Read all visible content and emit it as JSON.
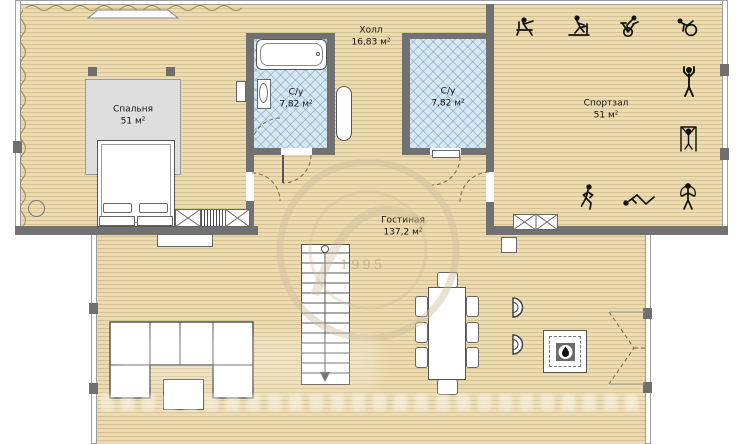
{
  "plan": {
    "title": "floor-plan",
    "rooms": {
      "bedroom": {
        "name": "Спальня",
        "area": "51 м²"
      },
      "hall": {
        "name": "Холл",
        "area": "16,83 м²"
      },
      "bathroom1": {
        "name": "С/у",
        "area": "7,82 м²"
      },
      "bathroom2": {
        "name": "С/у",
        "area": "7,82 м²"
      },
      "gym": {
        "name": "Спортзал",
        "area": "51 м²"
      },
      "living": {
        "name": "Гостиная",
        "area": "137,2 м²"
      }
    },
    "colors": {
      "floor": "#ecdbb0",
      "plank_line": "#d9c493",
      "inner_wall": "#717171",
      "outer_wall_line": "#9f9f9f",
      "bath_tile": "#d7e8f4",
      "tile_line": "#a9c8de",
      "carpet": "#dedede",
      "furniture_outline": "#555555",
      "icon": "#111111"
    },
    "gym_icons": [
      "bench-press",
      "treadmill",
      "exercise-bike",
      "fitness-ball",
      "arms-raise",
      "pull-up-bar",
      "running",
      "sit-ups",
      "jump-rope"
    ],
    "furniture": [
      "bed",
      "wardrobe",
      "radiator",
      "bathtub",
      "sink",
      "stairs",
      "sofa",
      "coffee-table",
      "dining-table",
      "dining-chairs",
      "armchairs",
      "fireplace",
      "window-radiator"
    ],
    "symbols": [
      "door-swing-arc",
      "stairs-down-arrow",
      "flame-icon",
      "attic-slope-squiggle"
    ]
  },
  "watermark": {
    "year": "1995"
  }
}
